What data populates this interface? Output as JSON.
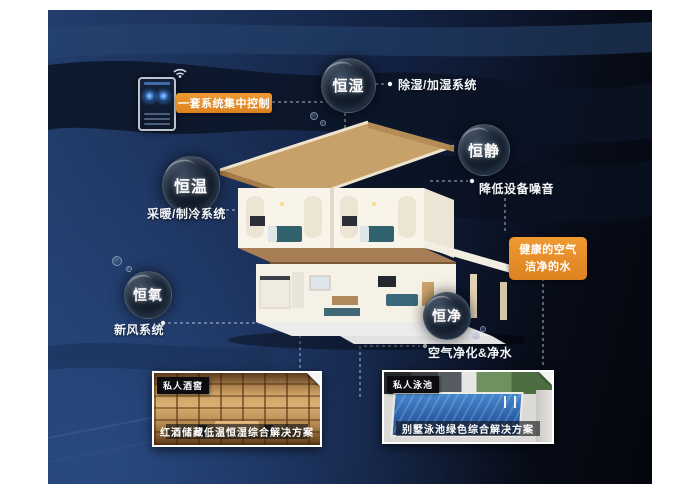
{
  "scene": {
    "background_color": "#122040",
    "accent_orange": "#e0872a",
    "icons": [
      "wifi-icon"
    ]
  },
  "control": {
    "label": "一套系统集中控制"
  },
  "features": [
    {
      "bubble": "恒湿",
      "desc": "除湿/加湿系统"
    },
    {
      "bubble": "恒静",
      "desc": "降低设备噪音"
    },
    {
      "bubble": "恒温",
      "desc": "采暖/制冷系统"
    },
    {
      "bubble": "恒氧",
      "desc": "新风系统"
    },
    {
      "bubble": "恒净",
      "desc": "空气净化&净水"
    }
  ],
  "highlight": {
    "line1": "健康的空气",
    "line2": "洁净的水"
  },
  "cards": [
    {
      "tag": "私人酒窖",
      "caption": "红酒储藏低温恒湿综合解决方案"
    },
    {
      "tag": "私人泳池",
      "caption": "别墅泳池绿色综合解决方案"
    }
  ]
}
